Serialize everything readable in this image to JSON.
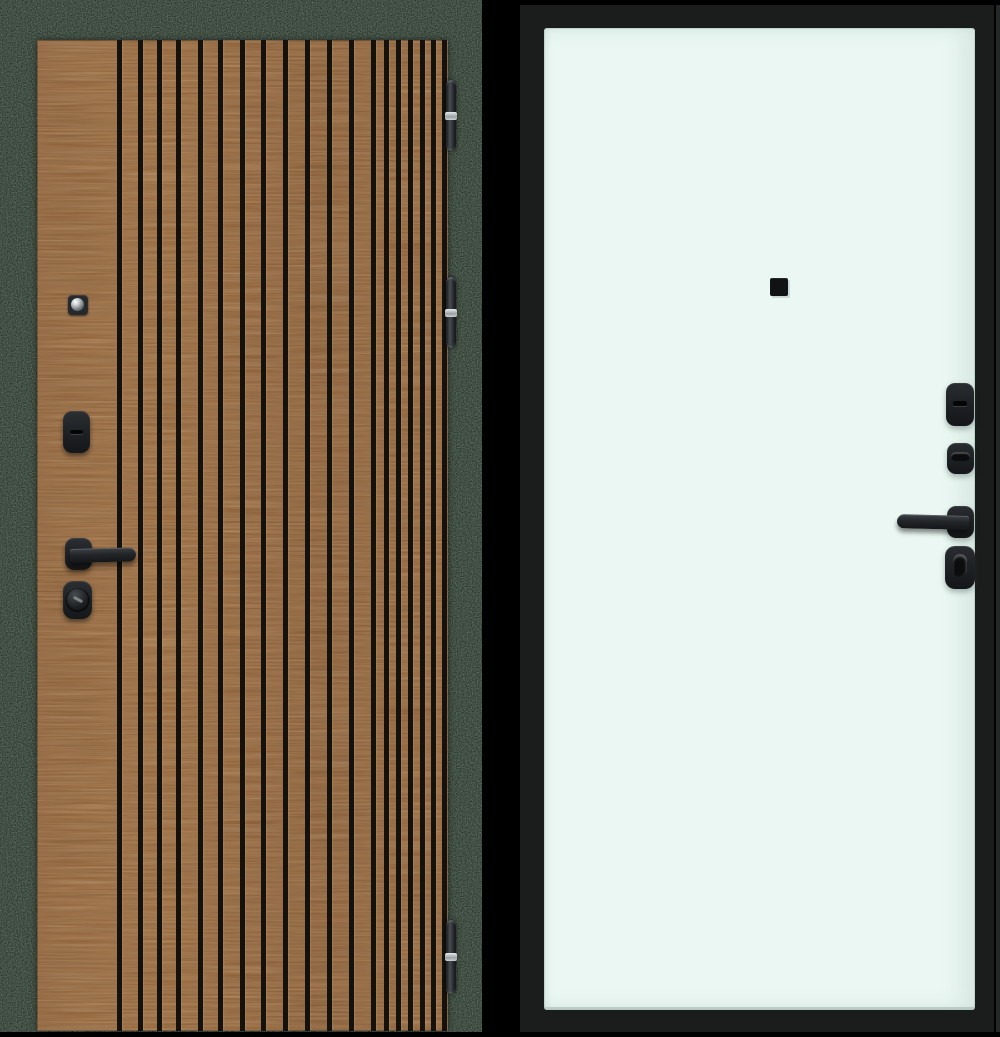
{
  "scene": {
    "subject": "entrance door, two sides shown",
    "left_view_label": "exterior side with vertical wood slats",
    "right_view_label": "interior side with flat light panel"
  },
  "colors": {
    "page_bg": "#000000",
    "exterior_frame": "#262c27",
    "exterior_wood": "#9a6a3e",
    "slat_groove": "#15110d",
    "hardware_black": "#1d2023",
    "hinge_metal": "#c7cccd",
    "interior_leaf": "#1b1d1d",
    "interior_panel": "#eaf7f2",
    "panel_edge": "#c2d2cd"
  },
  "left_door": {
    "groove_width": 5,
    "slat_grooves": [
      82,
      103,
      122,
      141,
      163,
      183,
      205,
      226,
      248,
      270,
      292,
      314,
      336,
      349,
      361,
      373,
      385,
      396,
      407
    ],
    "hinges": [
      {
        "top": 80,
        "height": 71
      },
      {
        "top": 277,
        "height": 71
      },
      {
        "top": 920,
        "height": 74
      }
    ],
    "hardware": [
      "peephole",
      "keyhole-escutcheon",
      "lever-handle",
      "cylinder-lock"
    ]
  },
  "right_door": {
    "hardware": [
      "peephole-cover",
      "keyhole-escutcheon",
      "thumbturn-escutcheon",
      "lever-handle",
      "night-lock-thumbturn"
    ]
  }
}
